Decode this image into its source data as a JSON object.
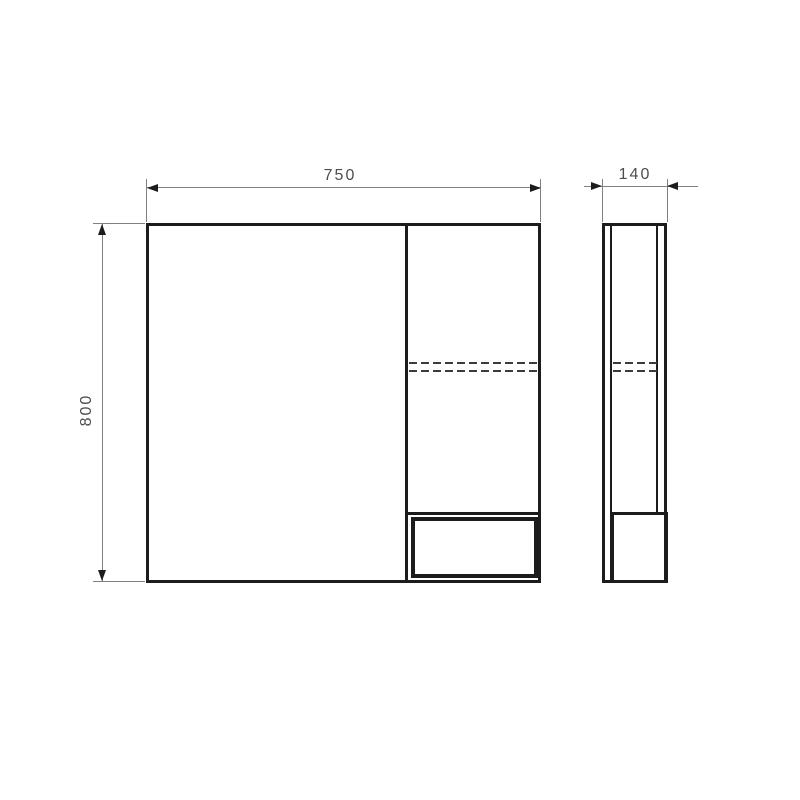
{
  "drawing": {
    "dimensions": {
      "width": {
        "label": "750"
      },
      "height": {
        "label": "800"
      },
      "depth": {
        "label": "140"
      }
    },
    "colors": {
      "background": "#ffffff",
      "object_line": "#1c1c1c",
      "dimension_line": "#808080",
      "dimension_text": "#4d4d4d",
      "dashed_line": "#3c3c3c"
    }
  }
}
